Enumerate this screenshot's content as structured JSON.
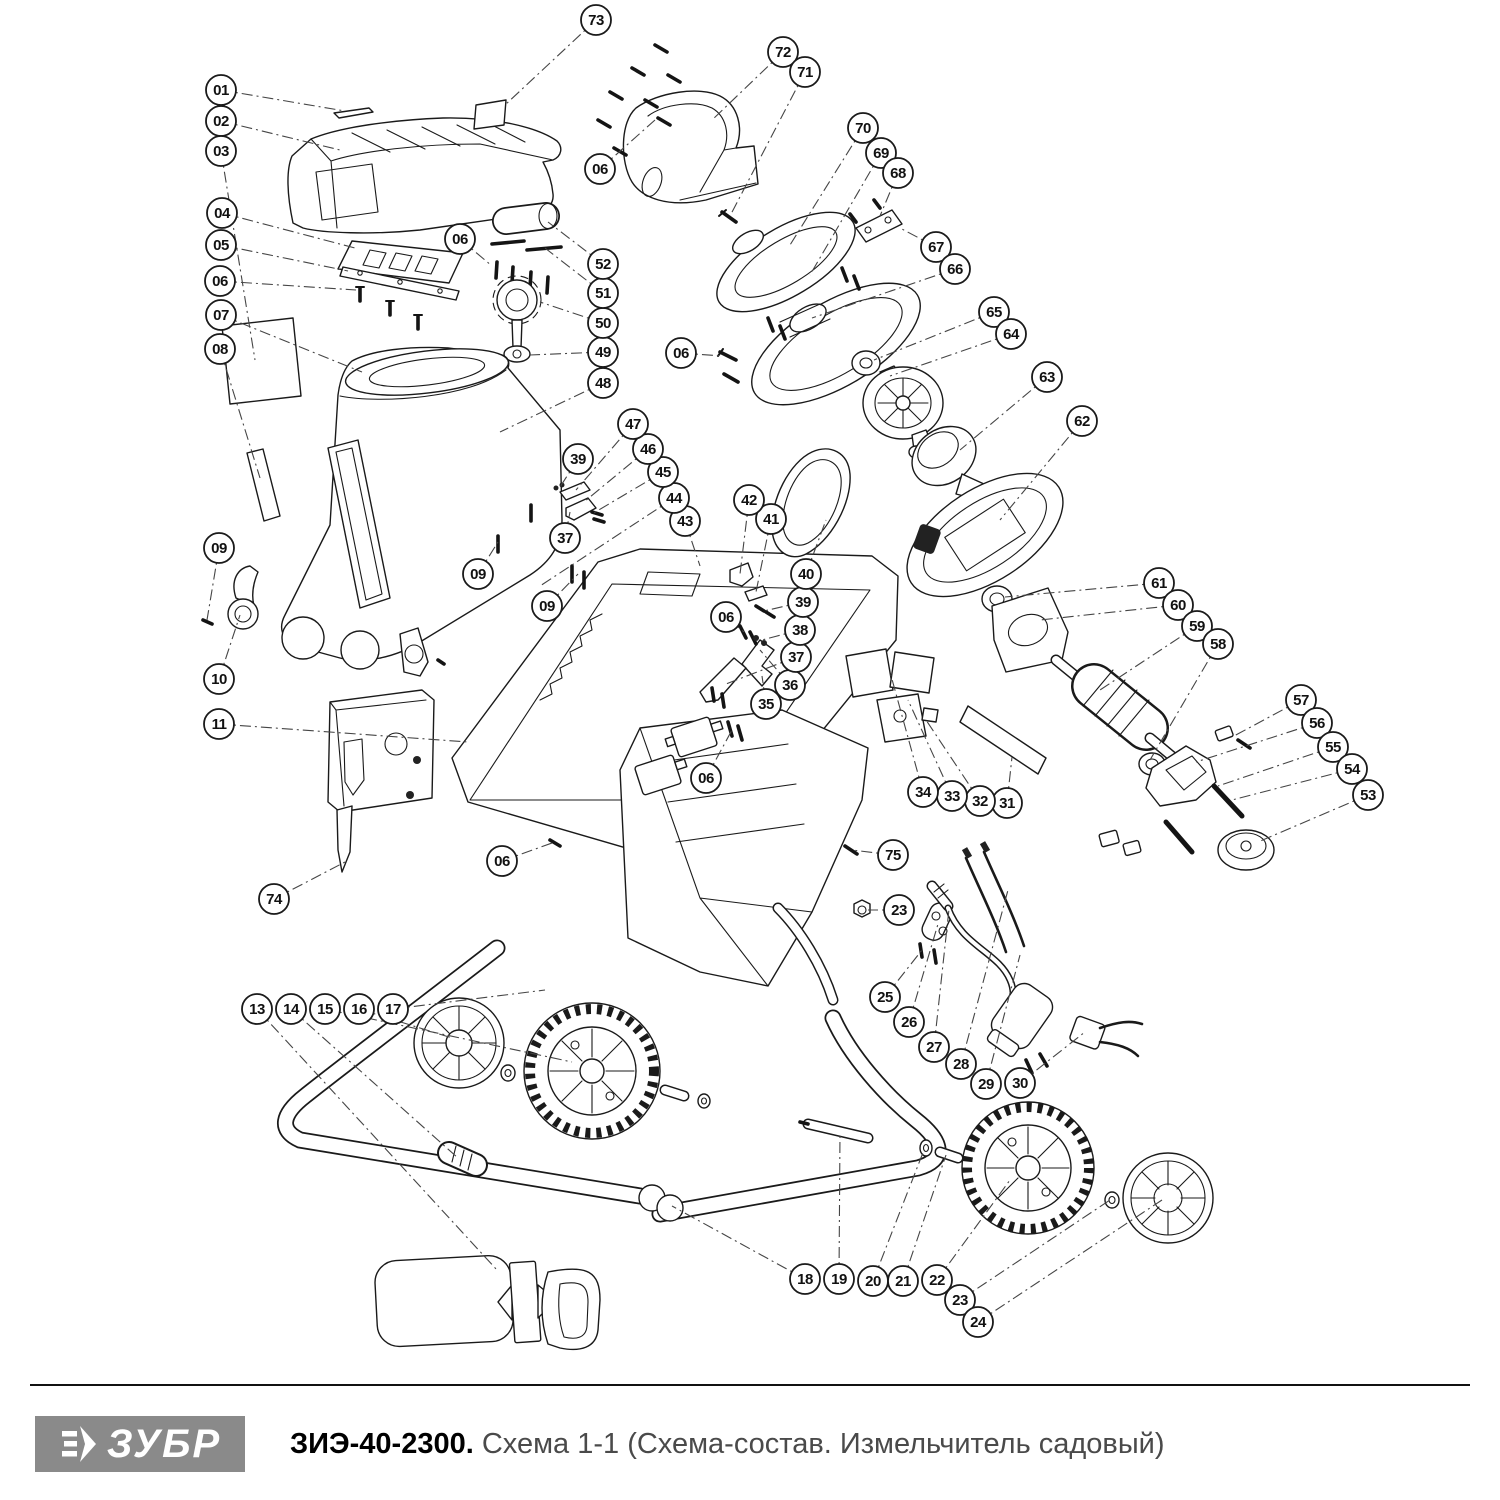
{
  "footer": {
    "logo_text": "ЗУБР",
    "logo_bg": "#8a8a8a",
    "title_bold": "ЗИЭ-40-2300.",
    "title_rest": " Схема 1-1 (Схема-состав. Измельчитель садовый)",
    "title_rest_color": "#4a4a4a",
    "divider_color": "#111111"
  },
  "diagram": {
    "ink": "#1a1a1a",
    "balloon_radius": 15,
    "balloons": [
      {
        "label": "01",
        "x": 221,
        "y": 90,
        "tx": 345,
        "ty": 111
      },
      {
        "label": "02",
        "x": 221,
        "y": 121,
        "tx": 340,
        "ty": 150
      },
      {
        "label": "03",
        "x": 221,
        "y": 151,
        "tx": 255,
        "ty": 360
      },
      {
        "label": "04",
        "x": 222,
        "y": 213,
        "tx": 355,
        "ty": 248
      },
      {
        "label": "05",
        "x": 221,
        "y": 245,
        "tx": 348,
        "ty": 271
      },
      {
        "label": "06",
        "x": 220,
        "y": 281,
        "tx": 356,
        "ty": 290
      },
      {
        "label": "07",
        "x": 221,
        "y": 315,
        "tx": 362,
        "ty": 372
      },
      {
        "label": "08",
        "x": 220,
        "y": 349,
        "tx": 260,
        "ty": 478
      },
      {
        "label": "09",
        "x": 219,
        "y": 548,
        "tx": 207,
        "ty": 620
      },
      {
        "label": "10",
        "x": 219,
        "y": 679,
        "tx": 240,
        "ty": 615
      },
      {
        "label": "11",
        "x": 219,
        "y": 724,
        "tx": 468,
        "ty": 742
      },
      {
        "label": "74",
        "x": 274,
        "y": 899,
        "tx": 345,
        "ty": 862
      },
      {
        "label": "13",
        "x": 257,
        "y": 1009,
        "tx": 497,
        "ty": 1270
      },
      {
        "label": "14",
        "x": 291,
        "y": 1009,
        "tx": 458,
        "ty": 1158
      },
      {
        "label": "15",
        "x": 325,
        "y": 1009,
        "tx": 572,
        "ty": 1062
      },
      {
        "label": "16",
        "x": 359,
        "y": 1009,
        "tx": 452,
        "ty": 1038
      },
      {
        "label": "17",
        "x": 393,
        "y": 1009,
        "tx": 545,
        "ty": 990
      },
      {
        "label": "18",
        "x": 805,
        "y": 1279,
        "tx": 672,
        "ty": 1206
      },
      {
        "label": "19",
        "x": 839,
        "y": 1279,
        "tx": 840,
        "ty": 1132
      },
      {
        "label": "20",
        "x": 873,
        "y": 1281,
        "tx": 924,
        "ty": 1150
      },
      {
        "label": "21",
        "x": 903,
        "y": 1281,
        "tx": 946,
        "ty": 1155
      },
      {
        "label": "22",
        "x": 937,
        "y": 1280,
        "tx": 1010,
        "ty": 1180
      },
      {
        "label": "23",
        "x": 960,
        "y": 1300,
        "tx": 1110,
        "ty": 1200
      },
      {
        "label": "24",
        "x": 978,
        "y": 1322,
        "tx": 1162,
        "ty": 1200
      },
      {
        "label": "25",
        "x": 885,
        "y": 997,
        "tx": 922,
        "ty": 950
      },
      {
        "label": "26",
        "x": 909,
        "y": 1022,
        "tx": 938,
        "ty": 924
      },
      {
        "label": "27",
        "x": 934,
        "y": 1047,
        "tx": 950,
        "ty": 900
      },
      {
        "label": "28",
        "x": 961,
        "y": 1064,
        "tx": 1008,
        "ty": 890
      },
      {
        "label": "29",
        "x": 986,
        "y": 1084,
        "tx": 1020,
        "ty": 955
      },
      {
        "label": "30",
        "x": 1020,
        "y": 1083,
        "tx": 1085,
        "ty": 1032
      },
      {
        "label": "75",
        "x": 893,
        "y": 855,
        "tx": 852,
        "ty": 850
      },
      {
        "label": "23",
        "x": 899,
        "y": 910,
        "tx": 868,
        "ty": 910
      },
      {
        "label": "31",
        "x": 1007,
        "y": 803,
        "tx": 1012,
        "ty": 757
      },
      {
        "label": "32",
        "x": 980,
        "y": 801,
        "tx": 926,
        "ty": 720
      },
      {
        "label": "33",
        "x": 952,
        "y": 796,
        "tx": 908,
        "ty": 700
      },
      {
        "label": "34",
        "x": 923,
        "y": 792,
        "tx": 890,
        "ty": 672
      },
      {
        "label": "06",
        "x": 706,
        "y": 778,
        "tx": 732,
        "ty": 730
      },
      {
        "label": "06",
        "x": 502,
        "y": 861,
        "tx": 552,
        "ty": 843
      },
      {
        "label": "35",
        "x": 766,
        "y": 704,
        "tx": 762,
        "ty": 676
      },
      {
        "label": "36",
        "x": 790,
        "y": 685,
        "tx": 760,
        "ty": 650
      },
      {
        "label": "37",
        "x": 796,
        "y": 657,
        "tx": 726,
        "ty": 684
      },
      {
        "label": "38",
        "x": 800,
        "y": 630,
        "tx": 762,
        "ty": 640
      },
      {
        "label": "39",
        "x": 803,
        "y": 602,
        "tx": 764,
        "ty": 611
      },
      {
        "label": "06",
        "x": 726,
        "y": 617,
        "tx": 744,
        "ty": 632
      },
      {
        "label": "40",
        "x": 806,
        "y": 574,
        "tx": 826,
        "ty": 520
      },
      {
        "label": "41",
        "x": 771,
        "y": 519,
        "tx": 756,
        "ty": 592
      },
      {
        "label": "42",
        "x": 749,
        "y": 500,
        "tx": 740,
        "ty": 574
      },
      {
        "label": "43",
        "x": 685,
        "y": 521,
        "tx": 700,
        "ty": 566
      },
      {
        "label": "44",
        "x": 674,
        "y": 498,
        "tx": 540,
        "ty": 586
      },
      {
        "label": "45",
        "x": 663,
        "y": 472,
        "tx": 592,
        "ty": 514
      },
      {
        "label": "46",
        "x": 648,
        "y": 449,
        "tx": 584,
        "ty": 502
      },
      {
        "label": "47",
        "x": 633,
        "y": 424,
        "tx": 576,
        "ty": 490
      },
      {
        "label": "39",
        "x": 578,
        "y": 459,
        "tx": 560,
        "ty": 487
      },
      {
        "label": "37",
        "x": 565,
        "y": 538,
        "tx": 570,
        "ty": 512
      },
      {
        "label": "09",
        "x": 478,
        "y": 574,
        "tx": 498,
        "ty": 542
      },
      {
        "label": "09",
        "x": 547,
        "y": 606,
        "tx": 578,
        "ty": 574
      },
      {
        "label": "48",
        "x": 603,
        "y": 383,
        "tx": 500,
        "ty": 432
      },
      {
        "label": "49",
        "x": 603,
        "y": 352,
        "tx": 530,
        "ty": 355
      },
      {
        "label": "50",
        "x": 603,
        "y": 323,
        "tx": 540,
        "ty": 302
      },
      {
        "label": "51",
        "x": 603,
        "y": 293,
        "tx": 545,
        "ty": 248
      },
      {
        "label": "52",
        "x": 603,
        "y": 264,
        "tx": 548,
        "ty": 222
      },
      {
        "label": "06",
        "x": 460,
        "y": 239,
        "tx": 492,
        "ty": 266
      },
      {
        "label": "06",
        "x": 600,
        "y": 169,
        "tx": 655,
        "ty": 120
      },
      {
        "label": "73",
        "x": 596,
        "y": 20,
        "tx": 505,
        "ty": 105
      },
      {
        "label": "72",
        "x": 783,
        "y": 52,
        "tx": 712,
        "ty": 120
      },
      {
        "label": "71",
        "x": 805,
        "y": 72,
        "tx": 730,
        "ty": 216
      },
      {
        "label": "70",
        "x": 863,
        "y": 128,
        "tx": 790,
        "ty": 245
      },
      {
        "label": "69",
        "x": 881,
        "y": 153,
        "tx": 810,
        "ty": 275
      },
      {
        "label": "68",
        "x": 898,
        "y": 173,
        "tx": 880,
        "ty": 216
      },
      {
        "label": "67",
        "x": 936,
        "y": 247,
        "tx": 900,
        "ty": 228
      },
      {
        "label": "66",
        "x": 955,
        "y": 269,
        "tx": 812,
        "ty": 318
      },
      {
        "label": "65",
        "x": 994,
        "y": 312,
        "tx": 874,
        "ty": 360
      },
      {
        "label": "64",
        "x": 1011,
        "y": 334,
        "tx": 890,
        "ty": 376
      },
      {
        "label": "06",
        "x": 681,
        "y": 353,
        "tx": 722,
        "ty": 356
      },
      {
        "label": "63",
        "x": 1047,
        "y": 377,
        "tx": 960,
        "ty": 450
      },
      {
        "label": "62",
        "x": 1082,
        "y": 421,
        "tx": 1000,
        "ty": 520
      },
      {
        "label": "61",
        "x": 1159,
        "y": 583,
        "tx": 1005,
        "ty": 597
      },
      {
        "label": "60",
        "x": 1178,
        "y": 605,
        "tx": 1040,
        "ty": 620
      },
      {
        "label": "59",
        "x": 1197,
        "y": 626,
        "tx": 1100,
        "ty": 690
      },
      {
        "label": "58",
        "x": 1218,
        "y": 644,
        "tx": 1150,
        "ty": 760
      },
      {
        "label": "57",
        "x": 1301,
        "y": 700,
        "tx": 1234,
        "ty": 736
      },
      {
        "label": "56",
        "x": 1317,
        "y": 723,
        "tx": 1196,
        "ty": 762
      },
      {
        "label": "55",
        "x": 1333,
        "y": 747,
        "tx": 1218,
        "ty": 786
      },
      {
        "label": "54",
        "x": 1352,
        "y": 769,
        "tx": 1232,
        "ty": 800
      },
      {
        "label": "53",
        "x": 1368,
        "y": 795,
        "tx": 1258,
        "ty": 842
      }
    ]
  }
}
